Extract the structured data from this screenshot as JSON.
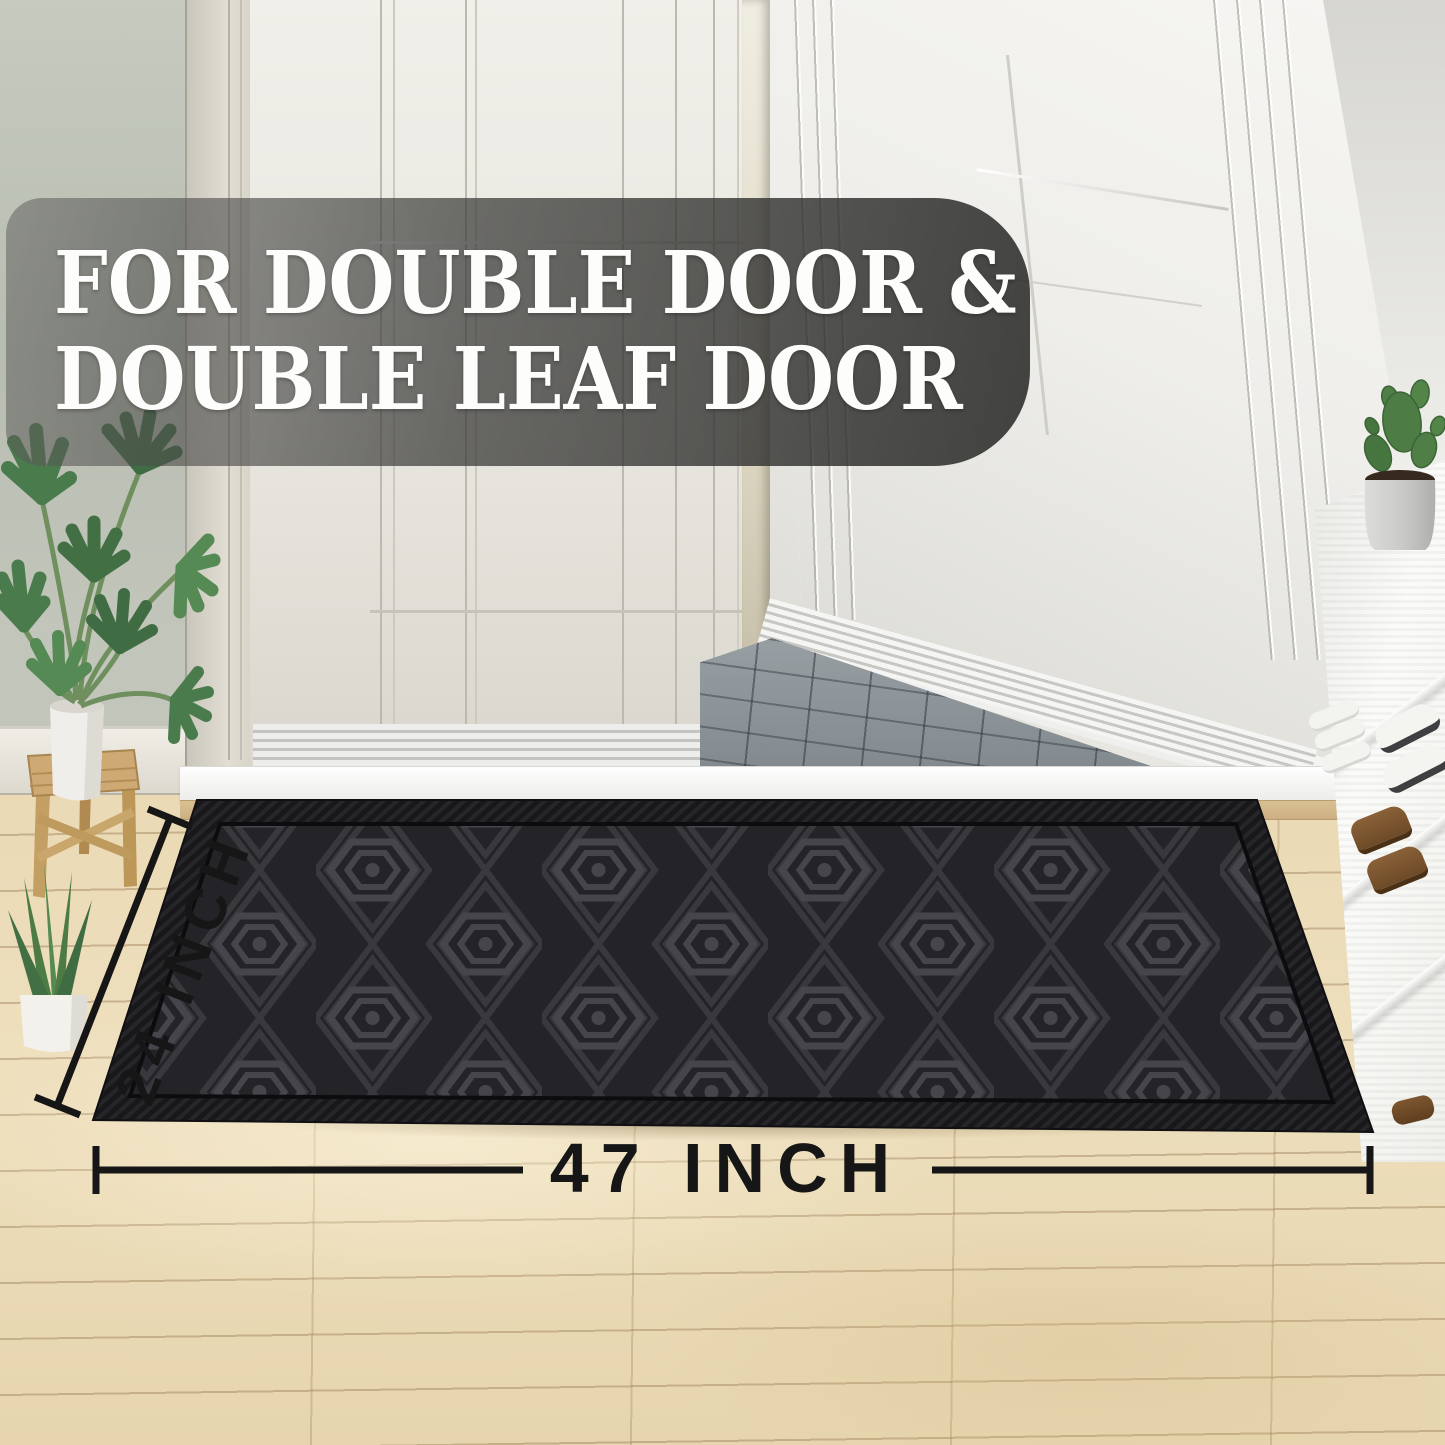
{
  "banner": {
    "line1": "FOR DOUBLE DOOR &",
    "line2": "DOUBLE LEAF DOOR"
  },
  "dimensions": {
    "height_label": "24 INCH",
    "width_label": "47 INCH"
  },
  "colors": {
    "banner_bg": "#3a3a38",
    "banner_text": "#ffffff",
    "dimension_text": "#161616",
    "mat_carpet": "#242428",
    "mat_border": "#1a1a1d",
    "mat_pattern": "#44444a",
    "floor_wood": "#ead9b4",
    "door_white": "#eceae4",
    "wall_left_grey": "#bcc1b6",
    "slate_grey": "#8a9196",
    "stone_beige": "#ddd6c4",
    "stool_wood": "#c9a66c",
    "plant_green": "#4a7b4c"
  },
  "objects": {
    "mat": "black textured door mat with diamond-hexagon pattern",
    "door_left": "closed white double-door leaf",
    "door_right": "open white double-door leaf",
    "doorway": "stone wall and slate paving outside",
    "left_decor": "monstera plant on wooden stool, aloe plant in white pot",
    "right_decor": "white shoe rack with cactus pot, white sneakers, slippers and brown boots"
  }
}
